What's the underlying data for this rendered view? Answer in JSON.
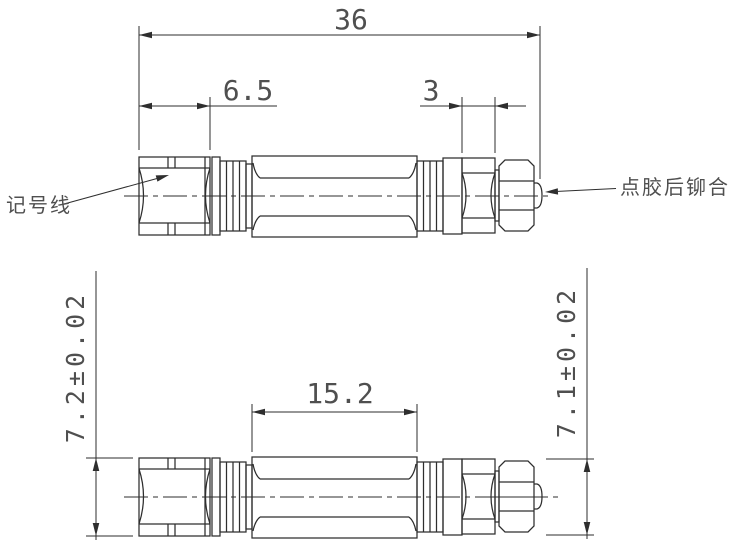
{
  "drawing_title": "connector two-view dimensioned drawing",
  "colors": {
    "line": "#2e2e2e",
    "text": "#4f4f4f",
    "background": "#ffffff"
  },
  "top_view": {
    "dim_overall_length": "36",
    "dim_left_hex_length": "6.5",
    "dim_coupling_length": "3",
    "leader_marking_line": "记号线",
    "leader_rivet_note": "点胶后铆合"
  },
  "bottom_view": {
    "dim_body_length": "15.2",
    "dim_left_hex_height": "7.2±0.02",
    "dim_right_nut_height": "7.1±0.02"
  }
}
